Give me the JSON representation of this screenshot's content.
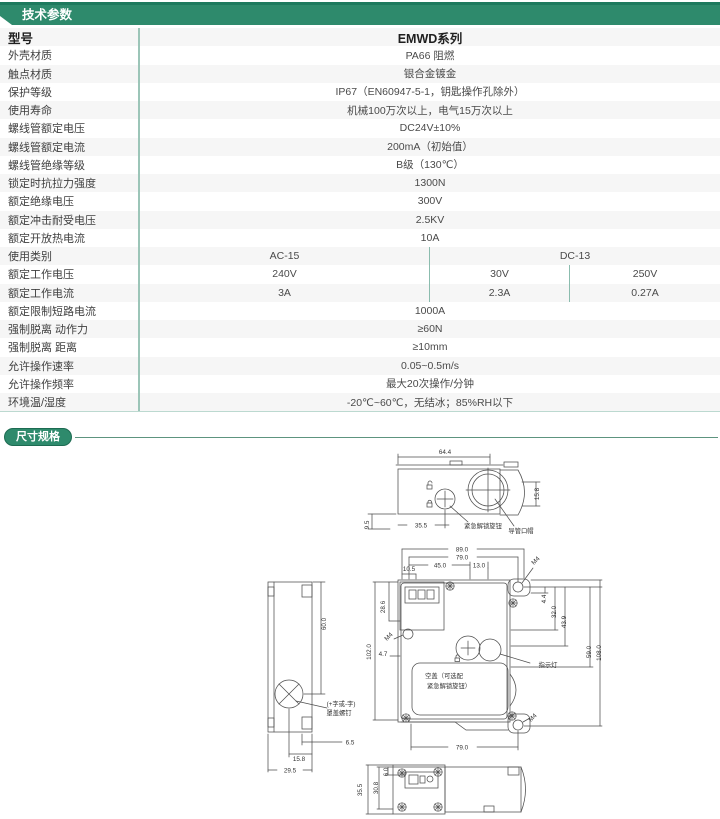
{
  "colors": {
    "accent_green": "#2e8a6c",
    "accent_dark": "#1e7a5e",
    "divider_teal": "#9cc5b8",
    "row_alt": "#f6f6f6",
    "line_gray": "#4f4f4f"
  },
  "tech_section": {
    "title": "技术参数"
  },
  "dim_section": {
    "title": "尺寸规格"
  },
  "tech_table": {
    "rows": [
      {
        "label": "型号",
        "value": "EMWD系列",
        "model": true
      },
      {
        "label": "外壳材质",
        "value": "PA66 阻燃"
      },
      {
        "label": "触点材质",
        "value": "银合金镀金"
      },
      {
        "label": "保护等级",
        "value": "IP67（EN60947-5-1，钥匙操作孔除外）"
      },
      {
        "label": "使用寿命",
        "value": "机械100万次以上，电气15万次以上"
      },
      {
        "label": "螺线管额定电压",
        "value": "DC24V±10%"
      },
      {
        "label": "螺线管额定电流",
        "value": "200mA（初始值）"
      },
      {
        "label": "螺线管绝缘等级",
        "value": "B级（130℃）"
      },
      {
        "label": "锁定时抗拉力强度",
        "value": "1300N"
      },
      {
        "label": "额定绝缘电压",
        "value": "300V"
      },
      {
        "label": "额定冲击耐受电压",
        "value": "2.5KV"
      },
      {
        "label": "额定开放热电流",
        "value": "10A"
      },
      {
        "label": "使用类别",
        "cols": [
          {
            "text": "AC-15",
            "w": 290,
            "div": true
          },
          {
            "text": "DC-13",
            "w": 290
          }
        ]
      },
      {
        "label": "额定工作电压",
        "cols": [
          {
            "text": "240V",
            "w": 290,
            "div": true
          },
          {
            "text": "30V",
            "w": 140,
            "div": true
          },
          {
            "text": "250V",
            "w": 150
          }
        ]
      },
      {
        "label": "额定工作电流",
        "cols": [
          {
            "text": "3A",
            "w": 290,
            "div": true
          },
          {
            "text": "2.3A",
            "w": 140,
            "div": true
          },
          {
            "text": "0.27A",
            "w": 150
          }
        ]
      },
      {
        "label": "额定限制短路电流",
        "value": "1000A"
      },
      {
        "label": "强制脱离 动作力",
        "value": "≥60N"
      },
      {
        "label": "强制脱离 距离",
        "value": "≥10mm"
      },
      {
        "label": "允许操作速率",
        "value": "0.05~0.5m/s"
      },
      {
        "label": "允许操作频率",
        "value": "最大20次操作/分钟"
      },
      {
        "label": "环境温/湿度",
        "value": "-20℃~60℃，无结冰；85%RH以下"
      }
    ]
  },
  "dimension_drawings": {
    "labels": [
      {
        "t": "64.4",
        "x": 445,
        "y": 452
      },
      {
        "t": "15.8",
        "x": 539,
        "y": 492,
        "r": -90
      },
      {
        "t": "9.5",
        "x": 369,
        "y": 523,
        "r": -90
      },
      {
        "t": "35.5",
        "x": 421,
        "y": 525.5
      },
      {
        "t": "紧急解锁旋钮",
        "x": 483,
        "y": 526
      },
      {
        "t": "导管口帽",
        "x": 521,
        "y": 531
      },
      {
        "t": "89.0",
        "x": 462,
        "y": 549.5
      },
      {
        "t": "79.0",
        "x": 462,
        "y": 557.5
      },
      {
        "t": "45.0",
        "x": 440,
        "y": 565.5
      },
      {
        "t": "13.0",
        "x": 479,
        "y": 565.5
      },
      {
        "t": "10.5",
        "x": 409,
        "y": 569
      },
      {
        "t": "M4",
        "x": 537,
        "y": 560,
        "r": -45
      },
      {
        "t": "28.6",
        "x": 385,
        "y": 605,
        "r": -90
      },
      {
        "t": "M4",
        "x": 390,
        "y": 636,
        "r": -45
      },
      {
        "t": "4.7",
        "x": 383,
        "y": 654
      },
      {
        "t": "102.0",
        "x": 371,
        "y": 650,
        "r": -90
      },
      {
        "t": "4.4",
        "x": 546,
        "y": 597,
        "r": -90
      },
      {
        "t": "32.0",
        "x": 556,
        "y": 610,
        "r": -90
      },
      {
        "t": "43.9",
        "x": 566,
        "y": 620,
        "r": -90
      },
      {
        "t": "59.0",
        "x": 591,
        "y": 650,
        "r": -90
      },
      {
        "t": "108.0",
        "x": 601,
        "y": 651,
        "r": -90
      },
      {
        "t": "指示灯",
        "x": 548,
        "y": 665
      },
      {
        "t": "空盖（可选配",
        "x": 444,
        "y": 676
      },
      {
        "t": "紧急解锁旋钮）",
        "x": 449,
        "y": 686
      },
      {
        "t": "M4",
        "x": 534,
        "y": 717,
        "r": -45
      },
      {
        "t": "79.0",
        "x": 462,
        "y": 747.5
      },
      {
        "t": "60.0",
        "x": 326,
        "y": 622,
        "r": -90
      },
      {
        "t": "(+字或-字)",
        "x": 341,
        "y": 704
      },
      {
        "t": "罩盖螺钉",
        "x": 339,
        "y": 713
      },
      {
        "t": "6.5",
        "x": 350,
        "y": 742.5
      },
      {
        "t": "15.8",
        "x": 299,
        "y": 759
      },
      {
        "t": "29.5",
        "x": 290,
        "y": 770.5
      },
      {
        "t": "35.5",
        "x": 362,
        "y": 788,
        "r": -90
      },
      {
        "t": "30.8",
        "x": 378,
        "y": 786,
        "r": -90
      },
      {
        "t": "6.0",
        "x": 388,
        "y": 770,
        "r": -90
      }
    ]
  }
}
